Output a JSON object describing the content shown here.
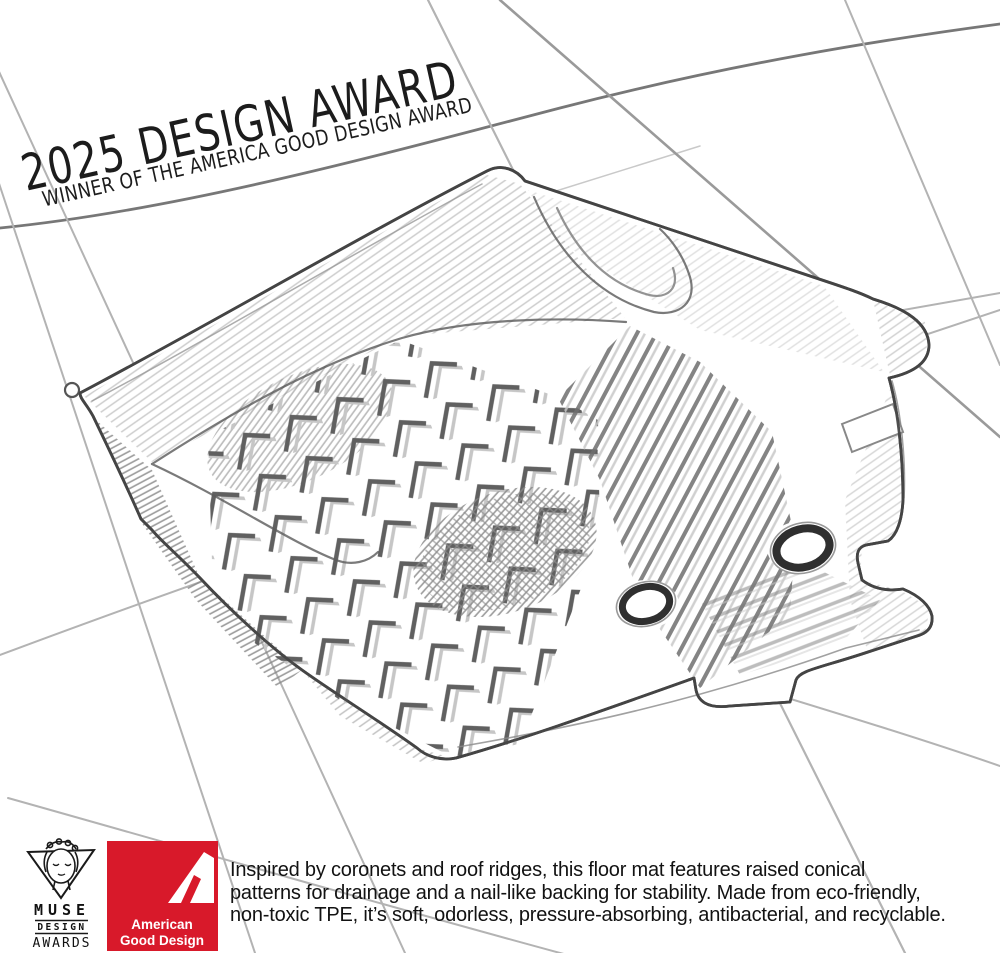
{
  "title": {
    "line1": "2025 DESIGN AWARD",
    "line2": "WINNER OF THE AMERICA GOOD DESIGN AWARD"
  },
  "badges": {
    "muse": {
      "word1": "MUSE",
      "word2": "DESIGN",
      "word3": "AWARDS"
    },
    "american_good_design": {
      "line1": "American",
      "line2": "Good Design",
      "bg_color": "#d8192a",
      "text_color": "#ffffff"
    }
  },
  "description": {
    "lines": [
      "Inspired by coronets and roof ridges, this floor mat features raised conical",
      "patterns for drainage and a nail-like backing for stability. Made from eco-friendly,",
      "non-toxic TPE, it’s soft, odorless, pressure-absorbing, antibacterial, and recyclable."
    ]
  },
  "sketch": {
    "pencil_color": "#454545",
    "grid_color": "#b3b3b3",
    "shading_color": "#8f8f8f"
  }
}
